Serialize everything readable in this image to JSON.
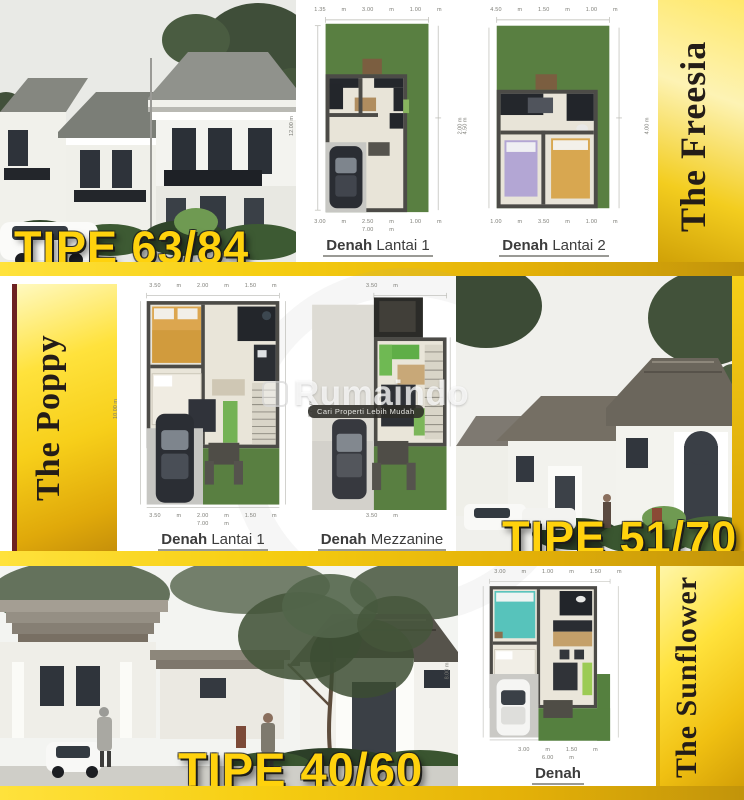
{
  "watermark": {
    "brand": "Rumaindo",
    "tagline": "Cari Properti Lebih Mudah"
  },
  "colors": {
    "accent_yellow": "#f7cf1a",
    "tipe_yellow": "#ffd20d",
    "series_text": "#241d18",
    "grass_green": "#597f41"
  },
  "sections": {
    "freesia": {
      "series_name": "The Freesia",
      "tipe_label": "TIPE 63/84",
      "plans": [
        {
          "label_bold": "Denah",
          "label_text": "Lantai 1",
          "dim_top": "1.35 m 3.00 m 1.00 m",
          "dim_bottom": "3.00 m 2.50 m 1.00 m",
          "dim_total": "7.00 m",
          "dim_left": "12.00 m",
          "dim_right": "4.50 m"
        },
        {
          "label_bold": "Denah",
          "label_text": "Lantai 2",
          "dim_top": "4.50 m 1.50 m 1.00 m",
          "dim_bottom": "1.00 m 3.50 m 1.00 m",
          "dim_total": "",
          "dim_left": "2.00 m",
          "dim_right": "4.00 m"
        }
      ]
    },
    "poppy": {
      "series_name": "The Poppy",
      "tipe_label": "TIPE 51/70",
      "plans": [
        {
          "label_bold": "Denah",
          "label_text": "Lantai 1",
          "dim_top": "3.50 m 2.00 m 1.50 m",
          "dim_bottom": "3.50 m 2.00 m 1.50 m",
          "dim_total": "7.00 m",
          "dim_left": "10.00 m",
          "dim_right": "2.75 m"
        },
        {
          "label_bold": "Denah",
          "label_text": "Mezzanine",
          "dim_top": "3.50 m",
          "dim_bottom": "3.50 m",
          "dim_total": "",
          "dim_left": "",
          "dim_right": "7.00 m"
        }
      ]
    },
    "sunflower": {
      "series_name": "The Sunflower",
      "tipe_label": "TIPE 40/60",
      "plans": [
        {
          "label_bold": "Denah",
          "label_text": "",
          "dim_top": "3.00 m 1.00 m 1.50 m",
          "dim_bottom": "3.00 m 1.50 m",
          "dim_total": "6.00 m",
          "dim_left": "8.00 m",
          "dim_right": "4.00 m"
        }
      ]
    }
  }
}
